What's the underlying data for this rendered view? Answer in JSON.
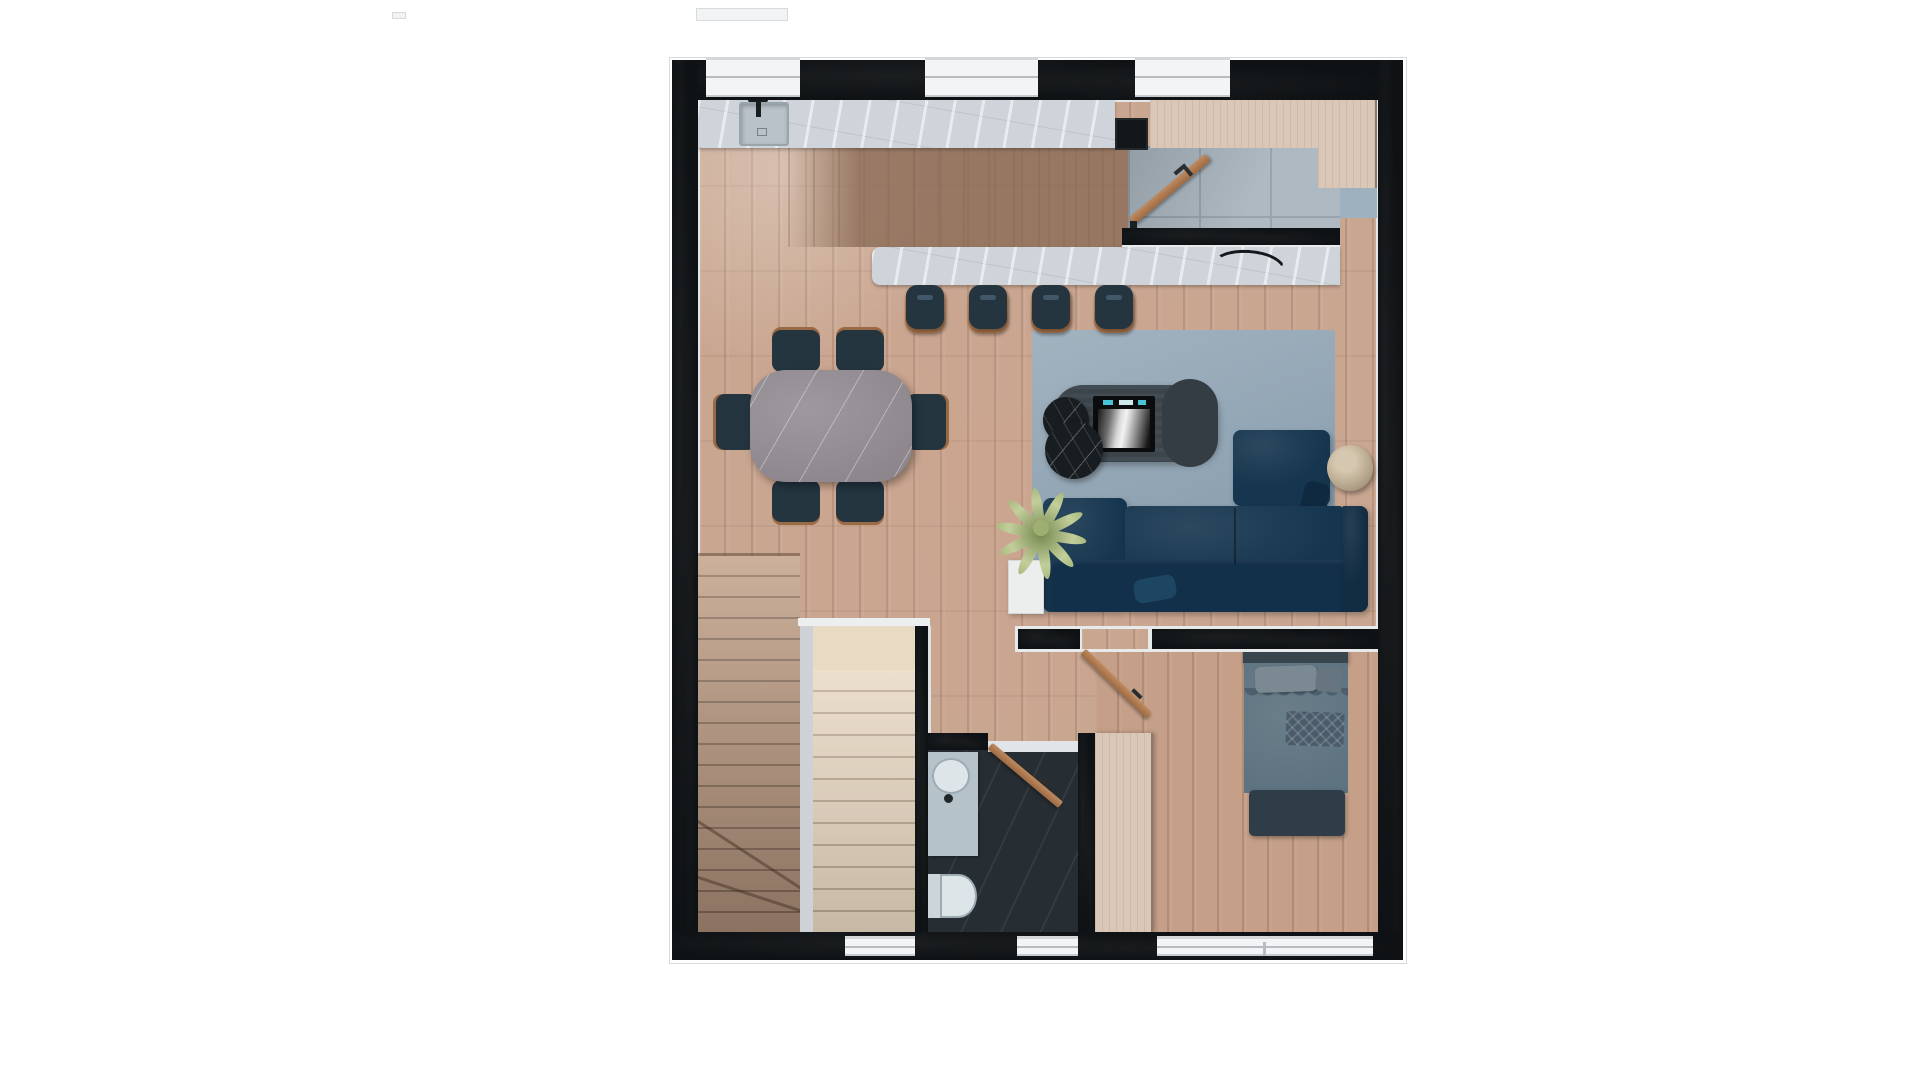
{
  "scene": {
    "type": "floor-plan-3d-render",
    "view": "top-down",
    "background": "#ffffff",
    "visible_text": "none"
  },
  "palette": {
    "wall": "#0f1214",
    "outline": "#d6dadd",
    "floor-main": "#c9a690",
    "floor-bedroom": "#c59f88",
    "tile-entry": "#a7b3bd",
    "tile-grout": "#8f9ca7",
    "counter": "#ced4d9",
    "rug": "#97aab9",
    "sofa": "#16364f",
    "seat-teal": "#243540",
    "wood-accent": "#ad7850",
    "marble-black": "#171d20",
    "tv-unit": "#3b454b",
    "stairs-light": "#e7d7c0",
    "stairs-dark": "#c19f86",
    "bath-floor": "#272e33",
    "fixture": "#dde5e9",
    "wardrobe": "#dac7b7",
    "bed-duvet": "#5e7380",
    "plant": "#9fae72",
    "window": "#f2f4f5"
  },
  "rooms": {
    "kitchen": {
      "features": [
        "wall-counter",
        "sink",
        "faucet",
        "cooktop-appliance",
        "bar-counter",
        "decor-branch"
      ],
      "bar_stools": 4
    },
    "dining": {
      "table": "rounded rectangular stone top",
      "chairs": 6
    },
    "living": {
      "rug": 1,
      "sofa": "L-shaped navy sectional",
      "chaise": 1,
      "coffee_table": "double round black marble",
      "tv_media_unit": 1,
      "tv_screen": 1,
      "plant": 1,
      "ball_pouf": 1,
      "pillows": 2
    },
    "entry": {
      "floor": "large gray tiles",
      "front_door": "open",
      "wardrobe_cabinet": 1,
      "door_mat": 1
    },
    "stairs": {
      "flights": 2,
      "winder_steps": true,
      "landing": 1
    },
    "bathroom": {
      "vanity_sink": 1,
      "toilet": 1,
      "door": "open",
      "floor": "dark slate"
    },
    "bedroom": {
      "bed": 1,
      "pillows": 2,
      "patterned_throw": 1,
      "foot_bench": 1,
      "closet_slab": 1,
      "door": "open"
    }
  },
  "architecture": {
    "exterior_walls": 4,
    "top_windows": 3,
    "bottom_windows": 3,
    "interior_partitions": [
      "entry-stub-wall",
      "stair-walls",
      "bathroom-walls",
      "living-bedroom-divider"
    ]
  }
}
